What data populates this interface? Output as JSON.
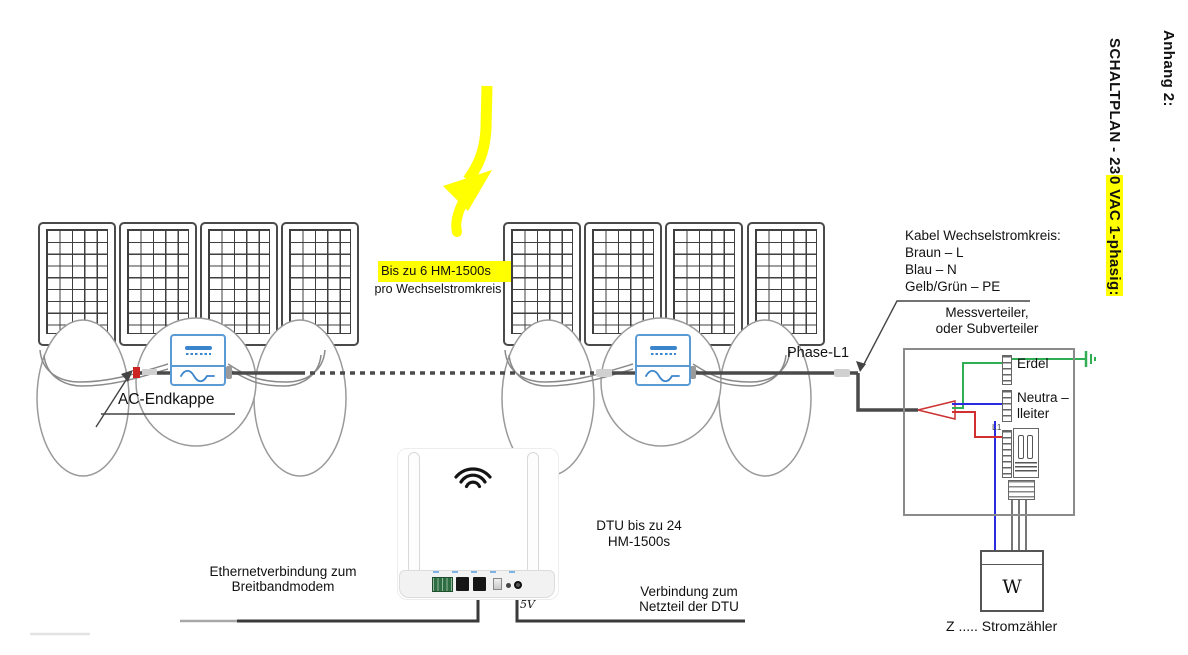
{
  "headings": {
    "appendix": "Anhang 2:",
    "title_prefix": "SCHALTPLAN - 23",
    "title_highlighted": "0 VAC 1-phasig:"
  },
  "labels": {
    "branch_capacity": "Bis zu 6 HM-1500s",
    "branch_capacity_sub": "pro Wechselstromkreis",
    "ac_endcap": "AC-Endkappe",
    "phase": "Phase-L1",
    "ac_cable_title": "Kabel Wechselstromkreis:",
    "ac_cable_brown": "Braun – L",
    "ac_cable_blue": "Blau – N",
    "ac_cable_pe": "Gelb/Grün – PE",
    "distributor_line1": "Messverteiler,",
    "distributor_line2": "oder Subverteiler",
    "earth_terminal": "Erdel",
    "neutral_line1": "Neutra –",
    "neutral_line2": "lleiter",
    "breaker": "L1",
    "meter_symbol": "W",
    "meter_legend": "Z ..... Stromzähler",
    "dtu_line1": "DTU bis zu 24",
    "dtu_line2": "HM-1500s",
    "ethernet_line1": "Ethernetverbindung zum",
    "ethernet_line2": "Breitbandmodem",
    "power_line1": "Verbindung zum",
    "power_line2": "Netzteil der DTU",
    "power_voltage": "5V"
  },
  "colors": {
    "highlight": "#ffff00",
    "wire_live": "#d23030",
    "wire_neutral": "#2a2ae0",
    "wire_earth": "#2fae53",
    "cable": "#4a4a4a",
    "inverter_accent": "#3a85cc"
  }
}
